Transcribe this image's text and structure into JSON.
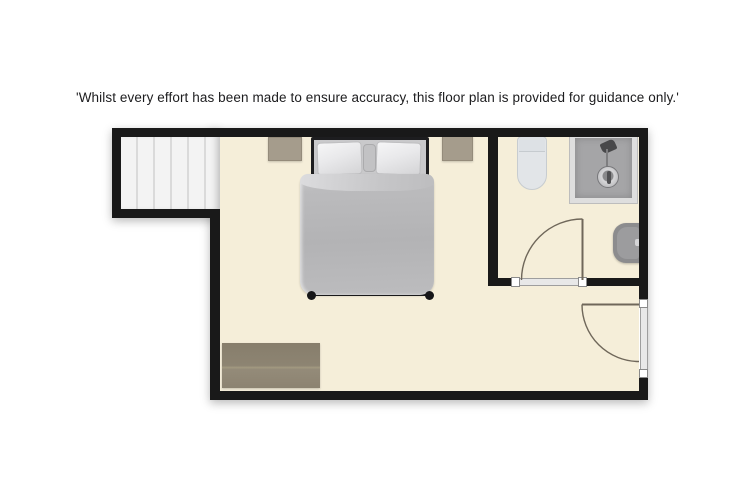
{
  "disclaimer": "'Whilst every effort has been made to ensure accuracy, this floor plan is provided for guidance only.'",
  "floor_plan": {
    "description": "Top-view floor plan of a bedroom with en-suite bathroom and staircase",
    "rooms": [
      {
        "name": "bedroom",
        "floor_color": "#f5eed9"
      },
      {
        "name": "en-suite-bathroom",
        "floor_color": "#f5eed9"
      },
      {
        "name": "staircase",
        "floor_color": "#f3f3f3"
      }
    ],
    "furniture": [
      {
        "name": "double-bed",
        "duvet_color": "#b5b5b7",
        "pillow_color": "#ededee",
        "frame_color": "#1d1d1f"
      },
      {
        "name": "nightstand-left",
        "color": "#a59c8c"
      },
      {
        "name": "nightstand-right",
        "color": "#a59c8c"
      },
      {
        "name": "dresser",
        "color": "#8d8472"
      },
      {
        "name": "toilet",
        "color": "#e2e5e8"
      },
      {
        "name": "shower",
        "color": "#a5a5a7"
      },
      {
        "name": "basin",
        "color": "#8c8c8e"
      }
    ],
    "doors": [
      {
        "name": "bathroom-door",
        "swing": "into bathroom, hinge right"
      },
      {
        "name": "entrance-door",
        "swing": "into bedroom, hinge top of right wall"
      }
    ],
    "colors": {
      "wall": "#191919",
      "floor": "#f5eed9",
      "page_background": "#ffffff",
      "door_line": "#6f675a"
    }
  }
}
